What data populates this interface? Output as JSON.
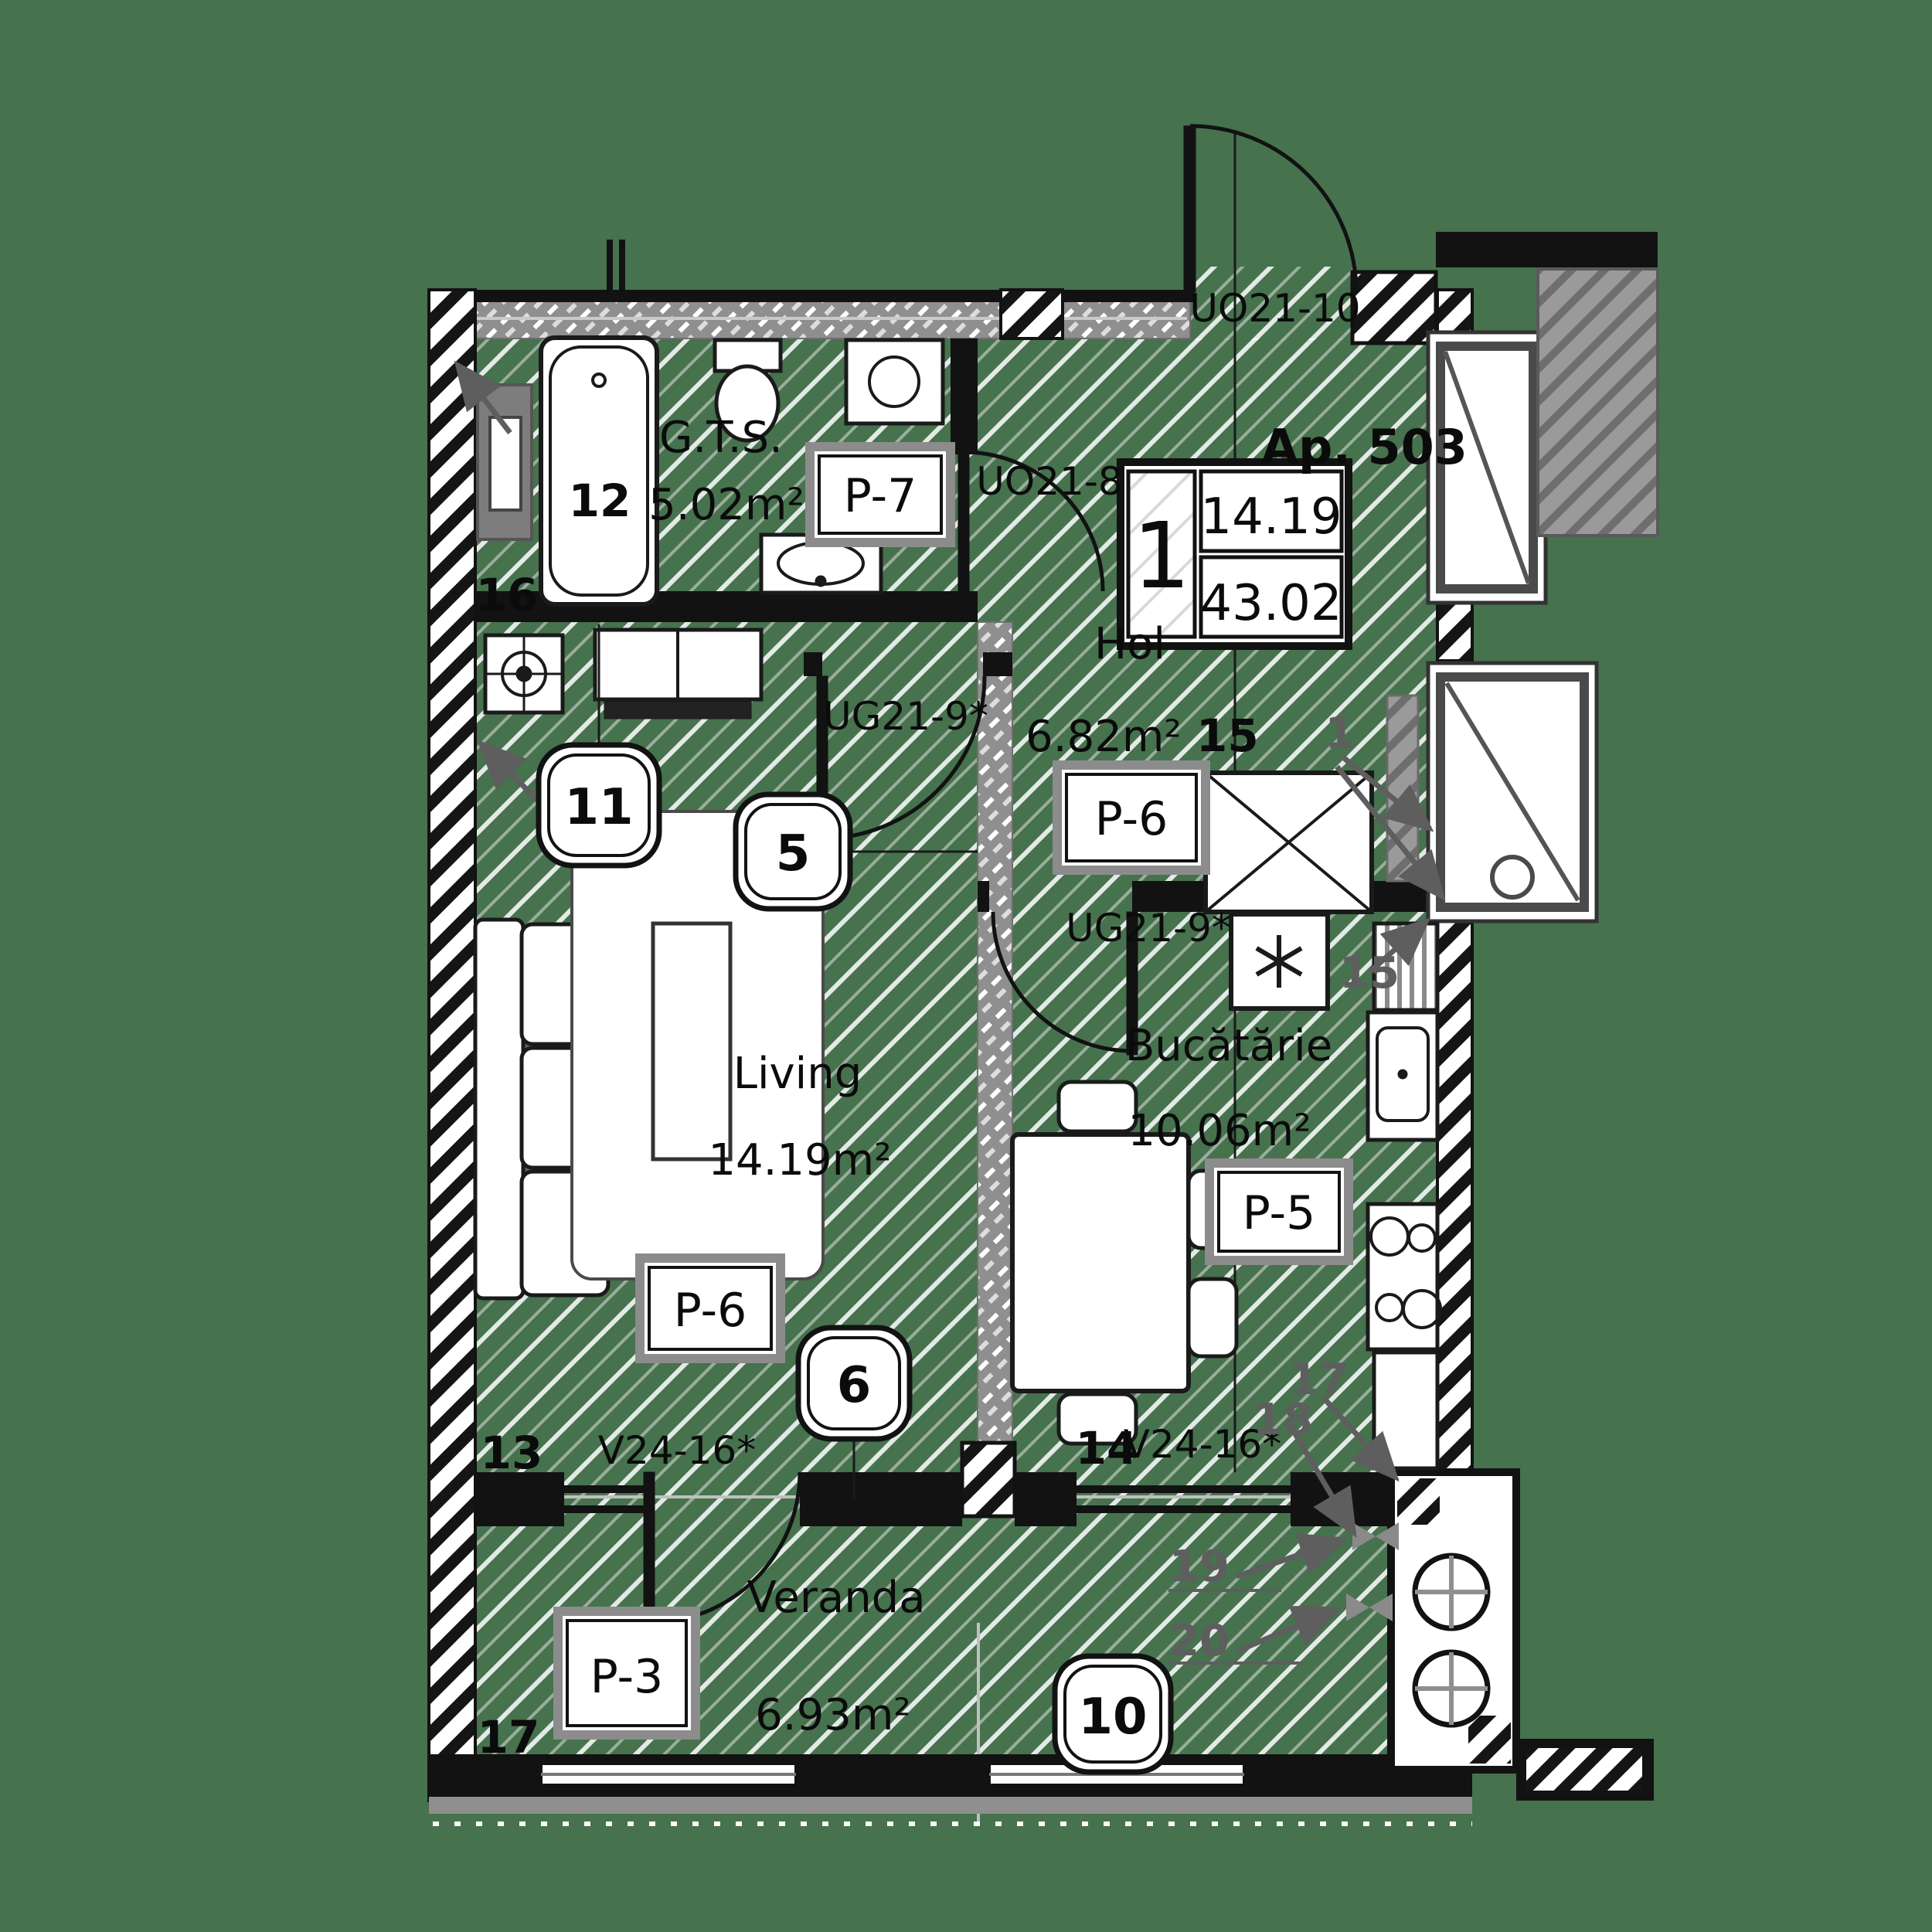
{
  "title": "Ap. 503",
  "info_table": {
    "rooms_count": "1",
    "living_area": "14.19",
    "total_area": "43.02"
  },
  "rooms": {
    "gts": {
      "name": "G.T.S.",
      "area": "5.02m²",
      "finish": "P-7",
      "fixture_no": "12"
    },
    "hol": {
      "name": "Hol",
      "area": "6.82m²",
      "finish": "P-6",
      "dim_no": "15"
    },
    "living": {
      "name": "Living",
      "area": "14.19m²",
      "finish": "P-6"
    },
    "kitchen": {
      "name": "Bucătărie",
      "area": "10.06m²",
      "finish": "P-5"
    },
    "veranda": {
      "name": "Veranda",
      "area": "6.93m²",
      "finish": "P-3"
    }
  },
  "doors": {
    "entrance": "UO21-10",
    "bathroom": "UO21-8",
    "living": "UG21-9*",
    "kitchen": "UG21-9*"
  },
  "windows": {
    "left": "V24-16*",
    "right": "V24-16*"
  },
  "circle_markers": {
    "m5": "5",
    "m6": "6",
    "m10": "10",
    "m11": "11"
  },
  "wall_numbers": {
    "n13": "13",
    "n14": "14",
    "n16": "16",
    "n17": "17"
  },
  "leader_numbers": {
    "l1": "1",
    "l15": "15",
    "l17": "17",
    "l18": "18",
    "l19": "19",
    "l20": "20"
  },
  "colors": {
    "background": "#46724E",
    "wall": "#121212",
    "band": "#8f8f8f",
    "leader": "#5e5e5e"
  }
}
